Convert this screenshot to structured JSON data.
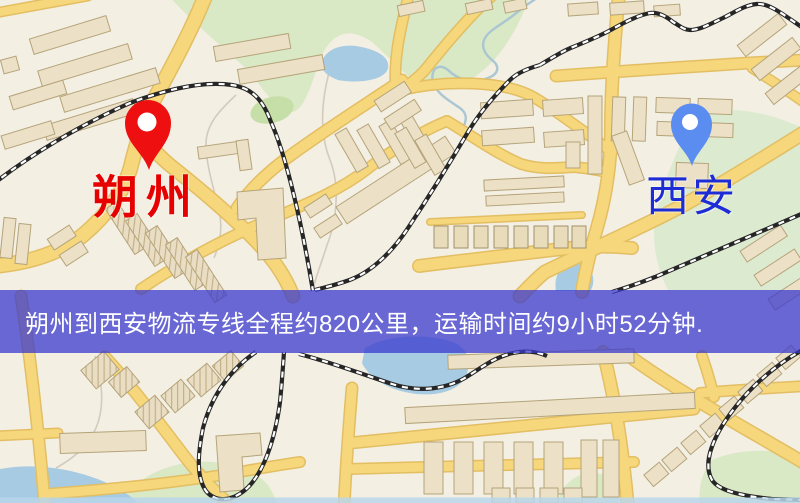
{
  "banner": {
    "text": "朔州到西安物流专线全程约820公里，运输时间约9小时52分钟.",
    "background": "rgba(58,58,206,0.75)",
    "text_color": "#ffffff"
  },
  "markers": {
    "origin": {
      "name": "朔州",
      "pin_color": "#ee1010",
      "label_color": "#e60000"
    },
    "destination": {
      "name": "西安",
      "pin_color": "#5b8df0",
      "label_color": "#1e2cd6"
    }
  },
  "map_palette": {
    "background": "#f3efe3",
    "road": "#f6d77c",
    "road_casing": "#e3be62",
    "building": "#ece0c6",
    "green_area": "#d9e8c5",
    "water": "#a6cbe2",
    "railway": "#262626"
  }
}
